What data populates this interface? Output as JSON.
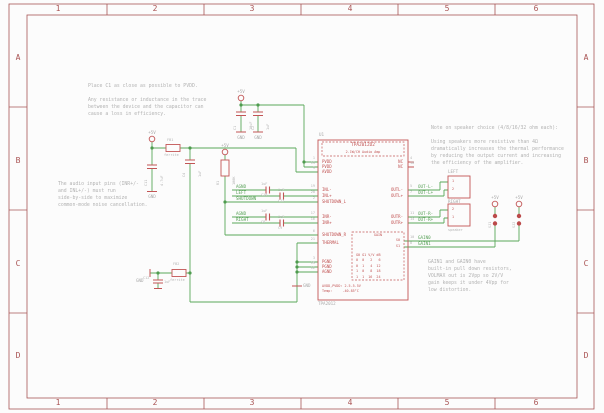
{
  "frame": {
    "columns": [
      "1",
      "2",
      "3",
      "4",
      "5",
      "6"
    ],
    "rows": [
      "A",
      "B",
      "C",
      "D"
    ]
  },
  "power": {
    "p5v": "+5V",
    "gnd": "GND"
  },
  "notes": {
    "c1": "Place C1 as close as possible to PVDD.\n\nAny resistance or inductance in the trace\nbetween the device and the capacitor can\ncause a loss in efficiency.",
    "inputs": "The audio input pins (INR+/-\nand INL+/-) must run\nside-by-side to maximize\ncommon-mode noise cancellation.",
    "speaker": "Note on speaker choice (4/8/16/32 ohm each):\n\nUsing speakers more resistive than 4Ω\ndramatically increases the thermal performance\nby reducing the output current and increasing\nthe efficiency of the amplifier.",
    "gain": "GAIN1 and GAIN0 have\nbuilt-in pull down resistors,\nVOLMAX out is 2Vpp so 2V/V\ngain keeps it under 4Vpp for\nlow distortion."
  },
  "ic": {
    "name": "U1",
    "value": "TPA2012",
    "title": "TPA2012D2",
    "subtitle": "2.1W/CH Audio Amp",
    "left_pins": [
      {
        "num": "1",
        "name": "PVDD"
      },
      {
        "num": "13",
        "name": "PVDD"
      },
      {
        "num": "9",
        "name": "AVDD"
      },
      {
        "num": "19",
        "name": "INL-"
      },
      {
        "num": "20",
        "name": "INL+"
      },
      {
        "num": "2",
        "name": "SHUTDOWN_L"
      },
      {
        "num": "17",
        "name": "INR-"
      },
      {
        "num": "16",
        "name": "INR+"
      },
      {
        "num": "6",
        "name": "SHUTDOWN_R"
      },
      {
        "num": "21",
        "name": "THERMAL"
      },
      {
        "num": "3",
        "name": "PGND"
      },
      {
        "num": "15",
        "name": "PGND"
      },
      {
        "num": "12",
        "name": "AGND"
      }
    ],
    "right_pins": [
      {
        "num": "4",
        "name": "NC"
      },
      {
        "num": "18",
        "name": "NC"
      },
      {
        "num": "5",
        "name": "OUTL-"
      },
      {
        "num": "7",
        "name": "OUTL+"
      },
      {
        "num": "11",
        "name": "OUTR-"
      },
      {
        "num": "14",
        "name": "OUTR+"
      }
    ],
    "gain_box": {
      "title": "GAIN",
      "s0": "S0",
      "s1": "S1",
      "table": "G0 G1 V/V dB\n0  0   2   6\n0  1   4  12\n1  0   8  18\n1  1  16  24"
    },
    "ratings": "AVDD,PVDD: 2.5-5.5V\nTemp:     -40-85°C"
  },
  "nets": {
    "agnd": "AGND",
    "left": "LEFT",
    "shutdown": "SHUTDOWN",
    "right": "RIGHT",
    "out_l_n": "OUT-L-",
    "out_l_p": "OUT-L+",
    "out_r_n": "OUT-R-",
    "out_r_p": "OUT-R+",
    "gain0": "GAIN0",
    "gain1": "GAIN1"
  },
  "net_nums": {
    "out_l_n": "5",
    "out_l_p": "7",
    "out_r_n": "11",
    "out_r_p": "14",
    "gain0": "10",
    "gain1": "8"
  },
  "components": {
    "fb1": {
      "name": "FB1",
      "value": "ferrite"
    },
    "fb2": {
      "name": "FB2",
      "value": "ferrite"
    },
    "r1": {
      "name": "R1",
      "value": "100K"
    },
    "c1": {
      "name": "C1",
      "value": "10uF"
    },
    "c2": {
      "name": "C2",
      "value": "1uF"
    },
    "c4": {
      "name": "C4",
      "value": "1uF"
    },
    "c8": {
      "name": "C8",
      "value": "1uF"
    },
    "c9": {
      "name": "C9",
      "value": "1uF"
    },
    "c10": {
      "name": "C10",
      "value": "1uF"
    },
    "c11": {
      "name": "C11",
      "value": "4.7uF"
    },
    "c12": {
      "name": "C12",
      "value": "1uF"
    },
    "c13": {
      "name": "C13",
      "value": "1uF"
    },
    "sj1": {
      "name": "SJ1"
    },
    "sj2": {
      "name": "SJ2"
    },
    "left_conn": {
      "name": "LEFT",
      "pin1": "1",
      "pin2": "2"
    },
    "right_conn": {
      "name": "RIGHT",
      "value": "speaker",
      "pin1": "2",
      "pin2": "1"
    }
  }
}
